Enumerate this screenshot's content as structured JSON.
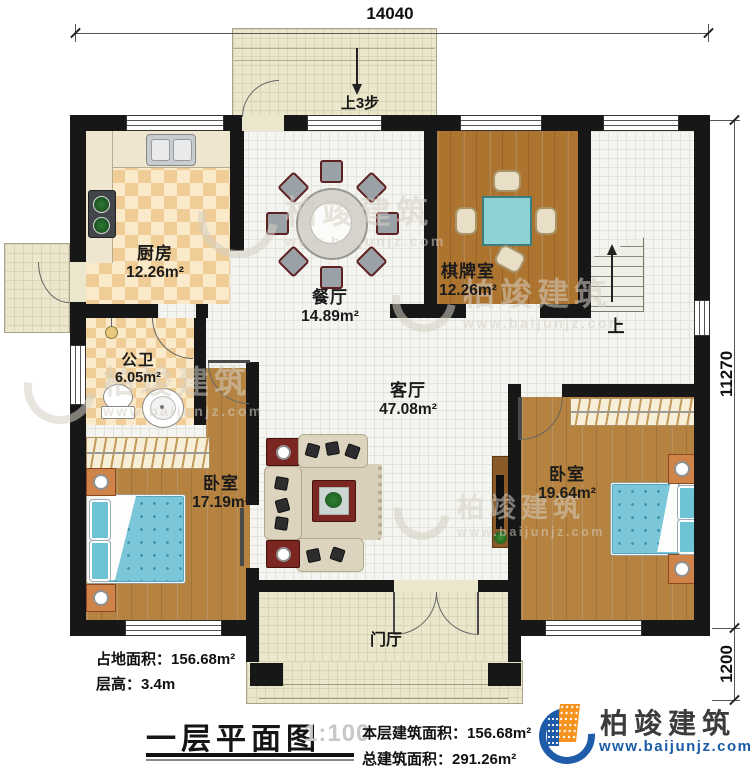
{
  "dims": {
    "top": "14040",
    "right_main": "11270",
    "right_lower": "1200"
  },
  "annotations": {
    "terrace_steps": "上3步",
    "stairs_up": "上",
    "foyer": "门厅"
  },
  "rooms": [
    {
      "id": "kitchen",
      "name": "厨房",
      "area": "12.26m²"
    },
    {
      "id": "dining",
      "name": "餐厅",
      "area": "14.89m²"
    },
    {
      "id": "chess",
      "name": "棋牌室",
      "area": "12.26m²"
    },
    {
      "id": "bath",
      "name": "公卫",
      "area": "6.05m²"
    },
    {
      "id": "living",
      "name": "客厅",
      "area": "47.08m²"
    },
    {
      "id": "bedroom_left",
      "name": "卧室",
      "area": "17.19m²"
    },
    {
      "id": "bedroom_right",
      "name": "卧室",
      "area": "19.64m²"
    }
  ],
  "info": {
    "area_label": "占地面积：",
    "area_value": "156.68m²",
    "height_label": "层高：",
    "height_value": "3.4m"
  },
  "title": {
    "text": "一层平面图",
    "scale": "1:100",
    "floor_label": "本层建筑面积：",
    "floor_value": "156.68m²",
    "total_label": "总建筑面积：",
    "total_value": "291.26m²"
  },
  "brand": {
    "name": "柏竣建筑",
    "site": "www.baijunjz.com"
  },
  "watermark": {
    "name": "柏竣建筑",
    "site": "www.baijunjz.com"
  }
}
